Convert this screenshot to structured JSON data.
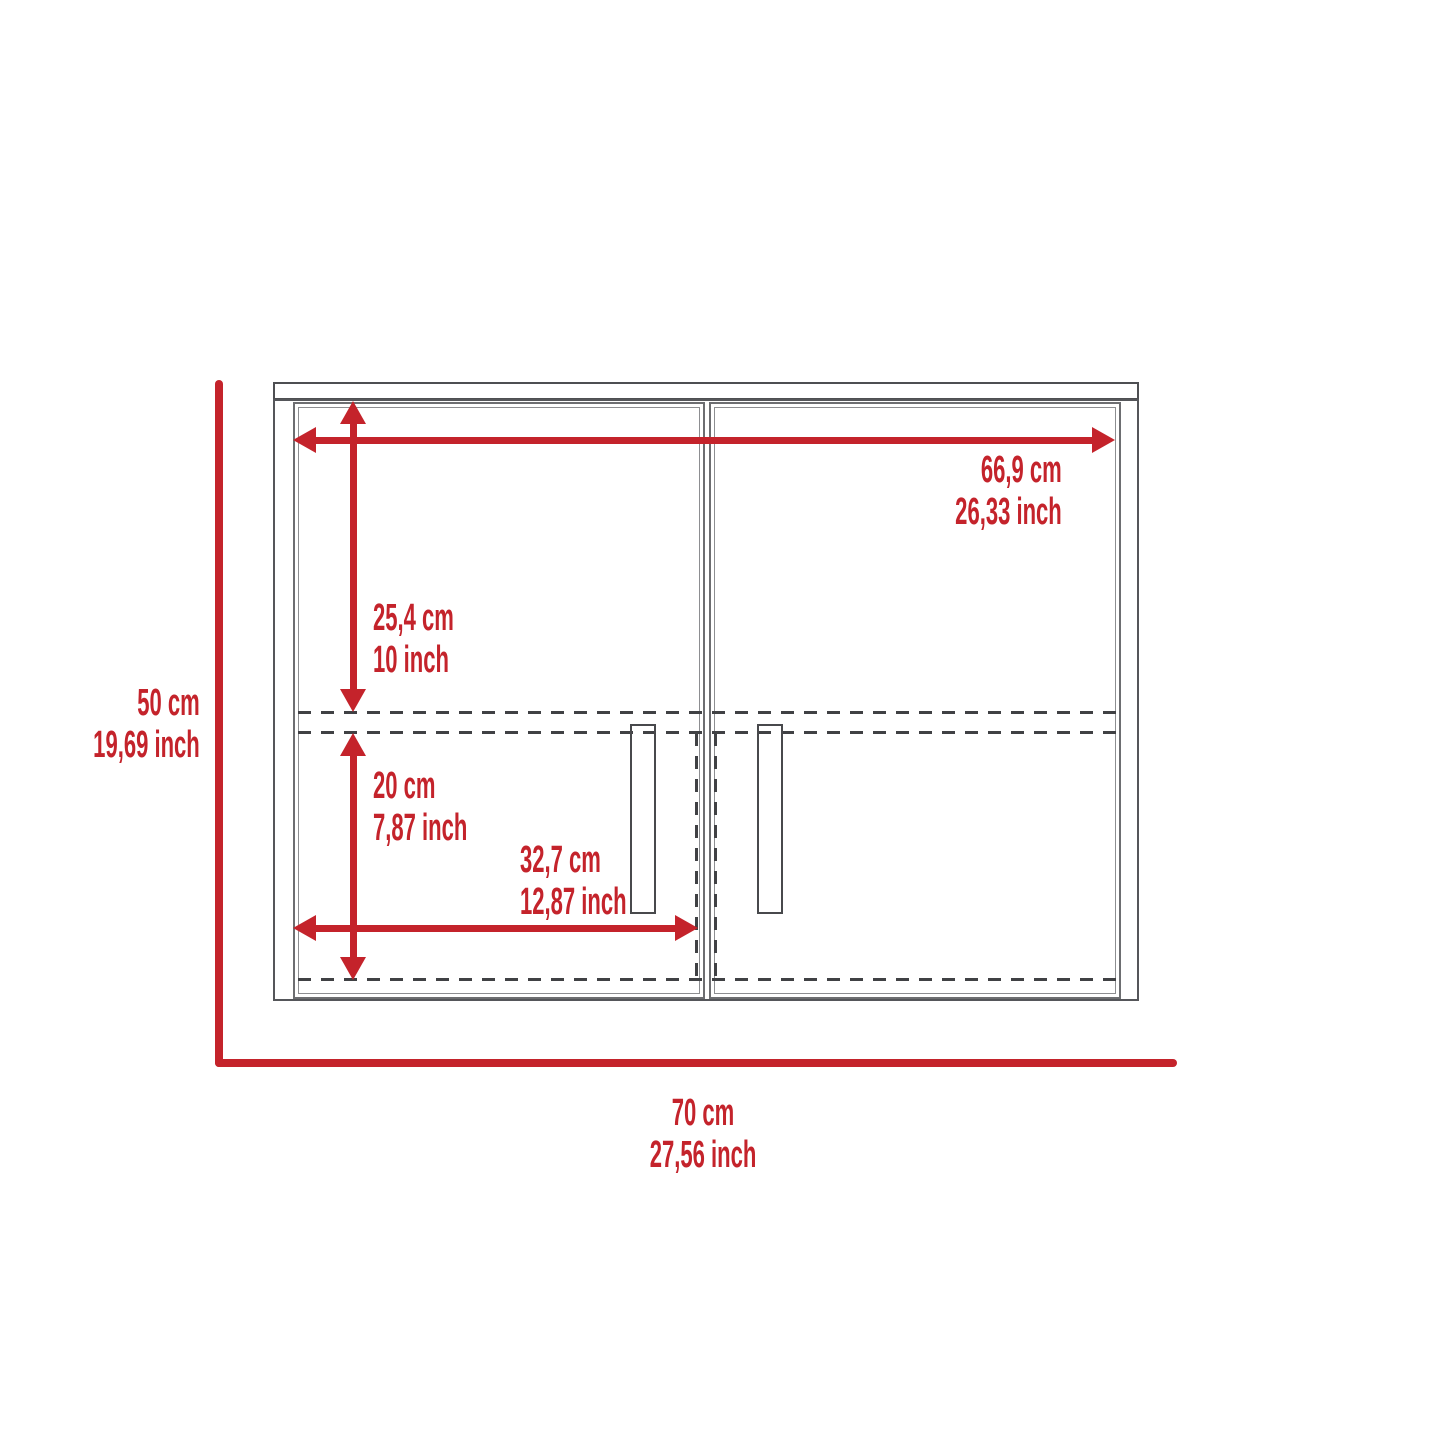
{
  "diagram": {
    "type": "furniture-dimension-drawing",
    "subject": "two-door wall cabinet front elevation",
    "colors": {
      "dimension_red": "#c4232b",
      "cabinet_line_gray": "#55565a",
      "dash_line_gray": "#404144",
      "background": "#ffffff"
    },
    "dimensions": {
      "interior_width": {
        "cm": "66,9 cm",
        "inch": "26,33 inch"
      },
      "upper_section_height": {
        "cm": "25,4 cm",
        "inch": "10 inch"
      },
      "overall_height": {
        "cm": "50 cm",
        "inch": "19,69 inch"
      },
      "lower_section_height": {
        "cm": "20 cm",
        "inch": "7,87 inch"
      },
      "door_width": {
        "cm": "32,7 cm",
        "inch": "12,87 inch"
      },
      "overall_width": {
        "cm": "70 cm",
        "inch": "27,56 inch"
      }
    }
  }
}
